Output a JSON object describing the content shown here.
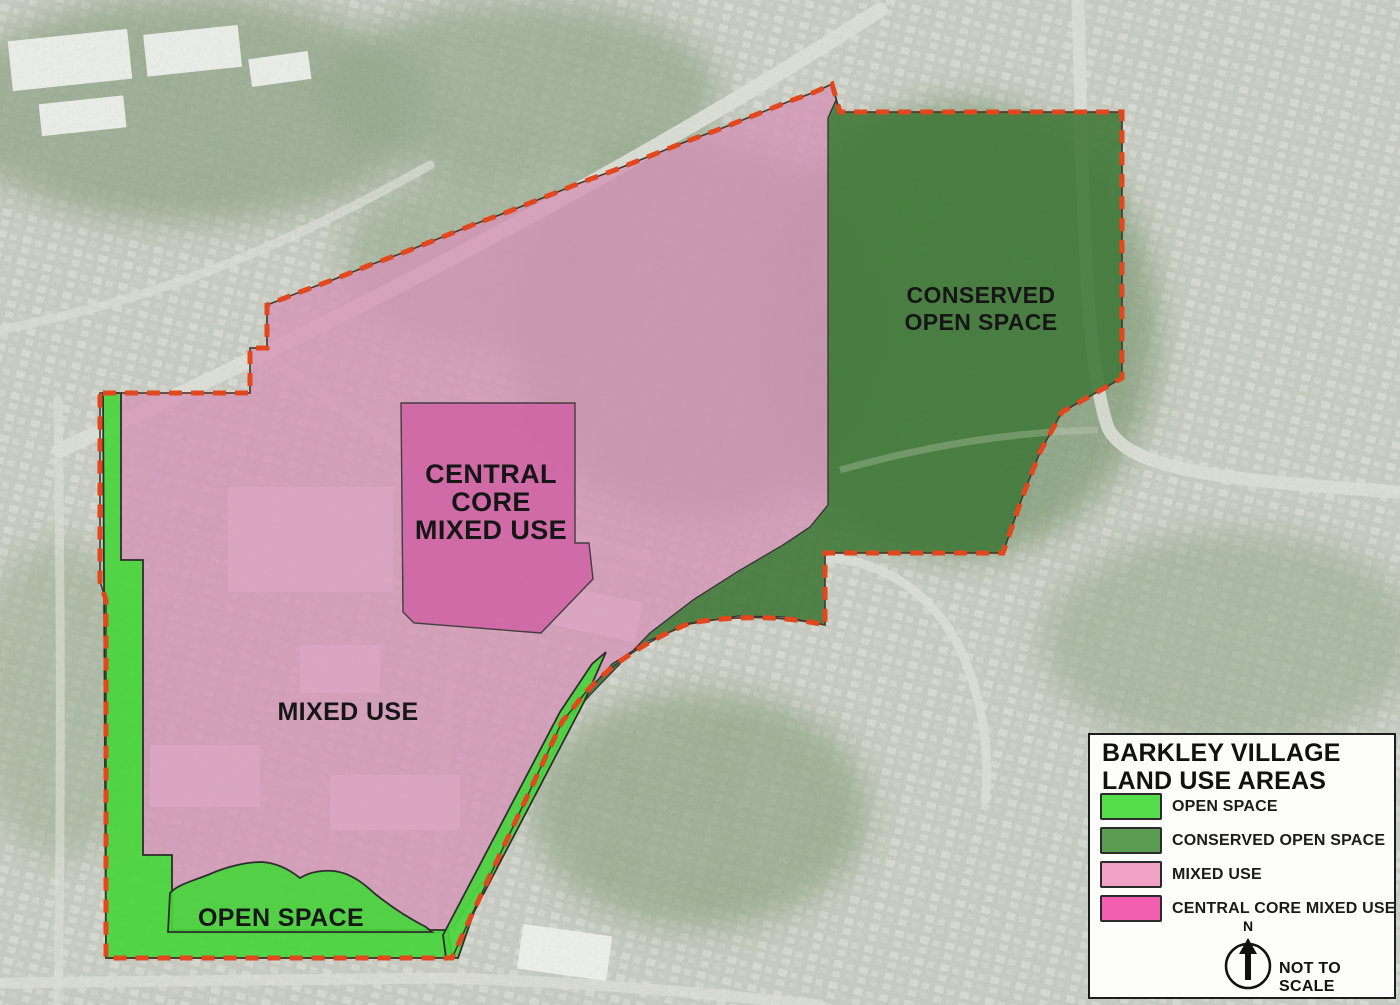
{
  "map": {
    "region_labels": {
      "conserved_open_space": [
        "CONSERVED",
        "OPEN SPACE"
      ],
      "central_core_mixed_use": [
        "CENTRAL",
        "CORE",
        "MIXED USE"
      ],
      "mixed_use": "MIXED USE",
      "open_space": "OPEN SPACE"
    },
    "zones": {
      "open_space": {
        "color": "#48d53c"
      },
      "conserved_open_space": {
        "color": "#41793a"
      },
      "mixed_use": {
        "color": "#d593b6"
      },
      "central_core_mixed_use": {
        "color": "#cf5fa4"
      }
    },
    "boundary_color": "#e2471d"
  },
  "legend": {
    "title_lines": [
      "BARKLEY VILLAGE",
      "LAND USE AREAS"
    ],
    "items": [
      {
        "label": "OPEN SPACE",
        "color": "#55dd4b"
      },
      {
        "label": "CONSERVED OPEN SPACE",
        "color": "#5a9c52"
      },
      {
        "label": "MIXED USE",
        "color": "#f0a3c6"
      },
      {
        "label": "CENTRAL CORE MIXED USE",
        "color": "#f25fb0"
      }
    ],
    "north_label": "N",
    "scale_note": "NOT TO SCALE"
  }
}
